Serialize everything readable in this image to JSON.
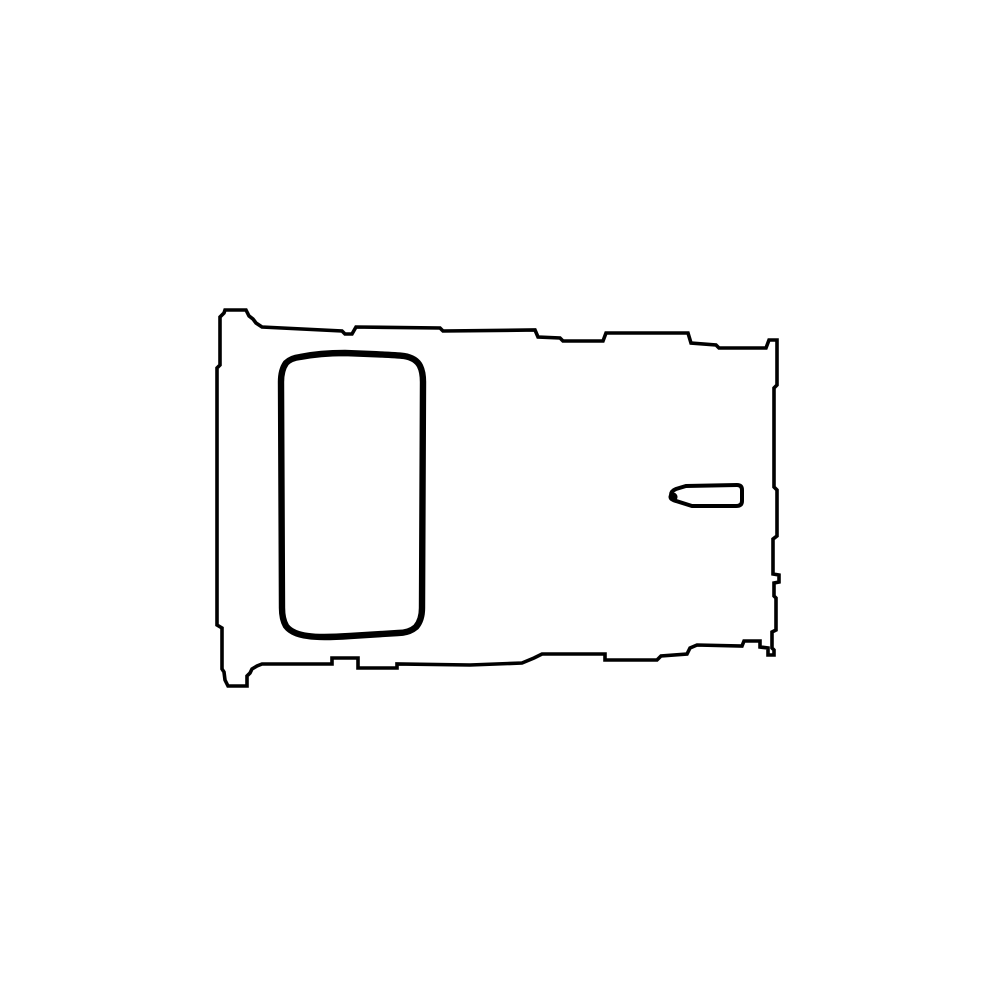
{
  "canvas": {
    "width": 1000,
    "height": 1000,
    "background_color": "#ffffff",
    "line_color": "#000000"
  },
  "drawing": {
    "label": "black outline line drawing of a tray-shaped part on a white background",
    "shapes": {
      "outer_outline": {
        "label": "irregular stepped rectangular outer outline with small tabs at top-left and bottom-left",
        "path": "M225 310 L246 310 L249 316 L253 319 L256 323 L262 327 L342 331 L345 334 L352 334 L356 327 L440 328 L443 331 L535 330 L538 337 L560 338 L563 341 L603 341 L606 333 L688 333 L691 343 L716 345 L719 348 L766 348 L769 340 L777 340 L777 385 L774 388 L774 487 L777 490 L777 536 L773 539 L773 574 L779 575 L779 582 L774 583 L774 596 L776 598 L776 630 L772 632 L772 648 L774 650 L774 655 L768 655 L768 648 L760 647 L760 641 L744 641 L742 646 L697 645 L690 648 L687 654 L661 656 L657 660 L605 660 L605 654 L542 654 L534 658 L522 663 L470 665 L397 664 L397 668 L358 668 L358 658 L332 658 L332 664 L262 664 L257 666 L252 669 L250 673 L247 676 L247 686 L228 686 L225 680 L224 672 L222 669 L222 628 L217 625 L217 368 L220 365 L220 317 L224 313 Z"
      },
      "inner_cutout": {
        "label": "thick rounded-rectangle cutout near the left side",
        "path": "M300 357 Q320 353 345 353 L370 354 Q395 355 404 356 Q416 358 420 366 Q423 372 423 382 L422 608 Q422 620 416 627 Q409 633 398 633 L350 636 Q320 638 308 636 Q292 634 286 626 Q282 619 282 608 L281 382 Q281 370 286 363 Q291 358 300 357 Z"
      },
      "side_slot": {
        "label": "small pill-shaped slot near the right edge, tapered at its left end",
        "path": "M686 486 L737 485 Q742 485 742 490 L742 501 Q742 506 736 506 L692 506 L676 501 Q671 500 671 495 Q671 491 676 489 Z"
      },
      "side_slot_tip": {
        "label": "thicker blob at the tapered left tip of the small slot",
        "path": "M673 492.5 a4.5 4.5 0 1 0 0.01 0 Z"
      }
    }
  }
}
